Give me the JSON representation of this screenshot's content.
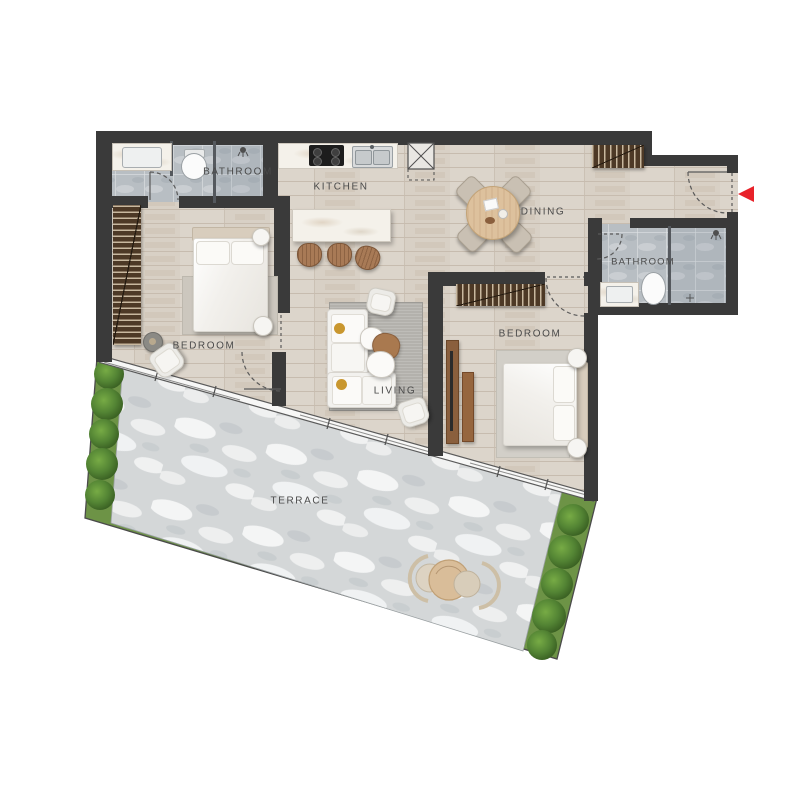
{
  "plan": {
    "rooms": {
      "bathroom1": {
        "label": "BATHROOM"
      },
      "kitchen": {
        "label": "KITCHEN"
      },
      "dining": {
        "label": "DINING"
      },
      "bathroom2": {
        "label": "BATHROOM"
      },
      "bedroom1": {
        "label": "BEDROOM"
      },
      "bedroom2": {
        "label": "BEDROOM"
      },
      "living": {
        "label": "LIVING"
      },
      "terrace": {
        "label": "TERRACE"
      }
    },
    "icons": {
      "entry_arrow": "entry-direction-marker"
    },
    "colors": {
      "wall": "#3a3a3a",
      "wood_floor": "#d8d0c5",
      "bath_tile": "#b8bec3",
      "terrace_stone": "#d5d8d9",
      "hedge_green": "#6d9346",
      "bush_green": "#4a7a2a",
      "entry_arrow_red": "#e8222a",
      "label_text": "#4a4a4a",
      "marble": "#f4f1ea",
      "wood_furniture": "#4d3926"
    }
  }
}
